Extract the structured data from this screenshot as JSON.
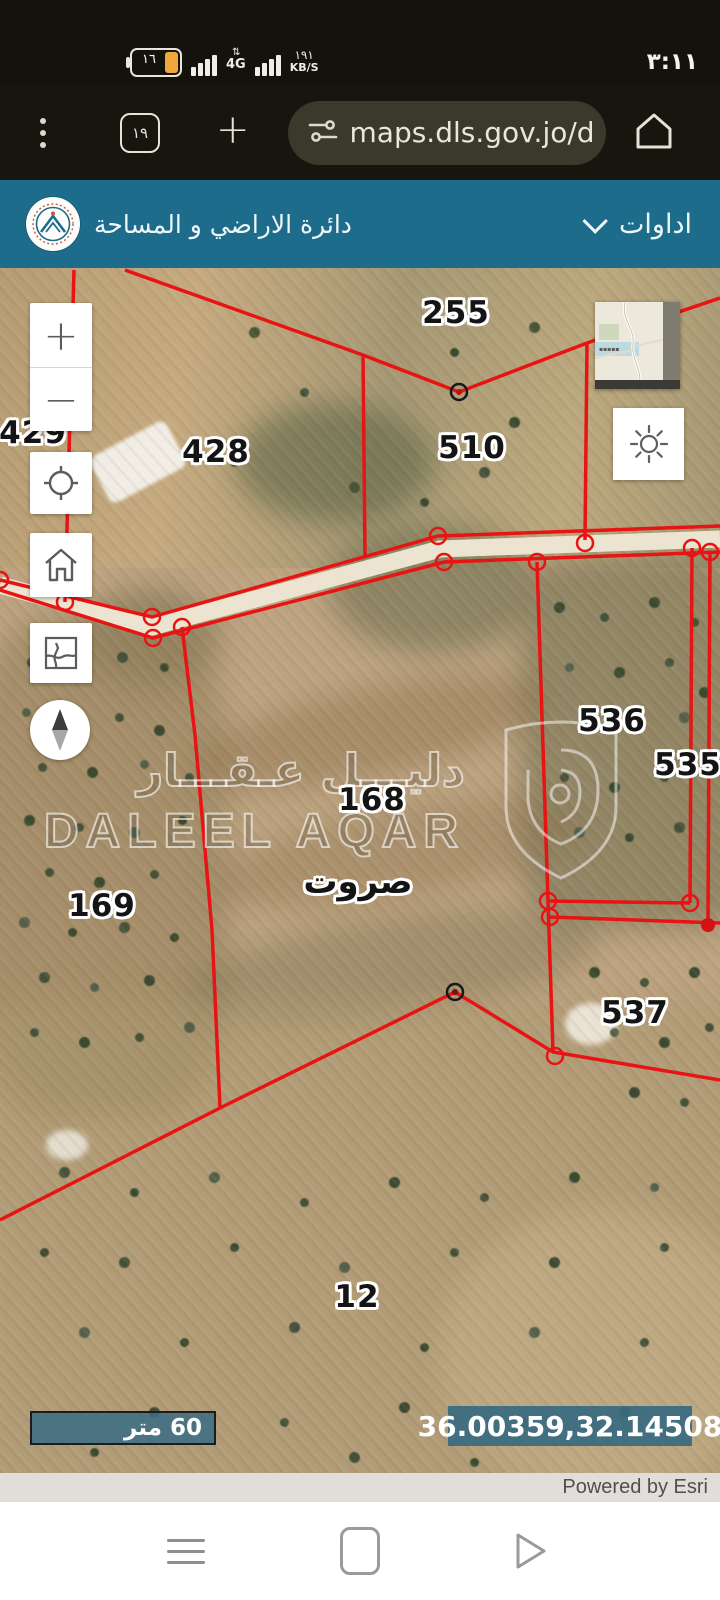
{
  "status_bar": {
    "time": "٣:١١",
    "battery_percent": "١٦",
    "network_badge": "4G",
    "network_arrows": "⇅",
    "net_speed": "١٩١",
    "net_speed_unit": "KB/S"
  },
  "browser_bar": {
    "tab_count": "١٩",
    "url_text": "maps.dls.gov.jo/d"
  },
  "app_header": {
    "title": "دائرة الاراضي و المساحة",
    "tools_menu_label": "اداوات"
  },
  "map": {
    "labels": [
      {
        "id": "parcel-255",
        "text": "255"
      },
      {
        "id": "parcel-429",
        "text": "429"
      },
      {
        "id": "parcel-428",
        "text": "428"
      },
      {
        "id": "parcel-510",
        "text": "510"
      },
      {
        "id": "parcel-536",
        "text": "536"
      },
      {
        "id": "parcel-535",
        "text": "535"
      },
      {
        "id": "parcel-168",
        "text": "168"
      },
      {
        "id": "place-sarut",
        "text": "صروت"
      },
      {
        "id": "parcel-169",
        "text": "169"
      },
      {
        "id": "parcel-537",
        "text": "537"
      },
      {
        "id": "parcel-12",
        "text": "12"
      }
    ],
    "controls": {
      "zoom_in": "+",
      "zoom_out": "−"
    },
    "watermark": {
      "arabic": "دليـــل عـقـــار",
      "latin": "DALEEL AQAR"
    },
    "scale_bar_label": "60 متر",
    "coordinates": "36.00359,32.14508",
    "attribution": "Powered by Esri"
  },
  "colors": {
    "header_teal": "#1d6c8b",
    "parcel_line_red": "#e81313",
    "overlay_teal": "#3e6d83",
    "status_bg": "#14120c"
  }
}
